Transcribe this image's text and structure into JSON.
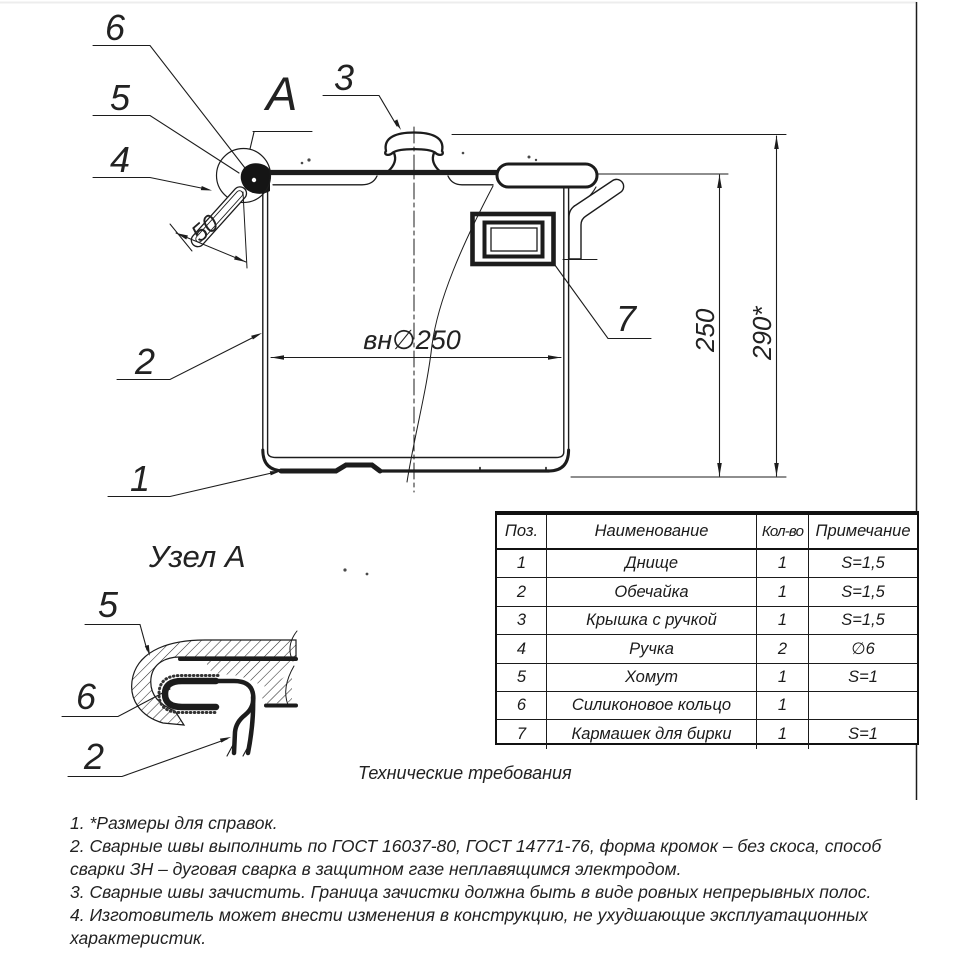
{
  "drawing": {
    "view_label": "А",
    "detail_title": "Узел А",
    "callouts": {
      "main": {
        "n1": "1",
        "n2": "2",
        "n3": "3",
        "n4": "4",
        "n5": "5",
        "n6": "6",
        "n7": "7"
      },
      "detail": {
        "n2": "2",
        "n5": "5",
        "n6": "6"
      }
    },
    "dimensions": {
      "handle_length": "50",
      "inner_diameter": "вн∅250",
      "body_height": "250",
      "total_height": "290*"
    }
  },
  "parts_table": {
    "headers": {
      "pos": "Поз.",
      "name": "Наименование",
      "qty": "Кол-во",
      "note": "Примечание"
    },
    "rows": [
      {
        "pos": "1",
        "name": "Днище",
        "qty": "1",
        "note": "S=1,5"
      },
      {
        "pos": "2",
        "name": "Обечайка",
        "qty": "1",
        "note": "S=1,5"
      },
      {
        "pos": "3",
        "name": "Крышка с ручкой",
        "qty": "1",
        "note": "S=1,5"
      },
      {
        "pos": "4",
        "name": "Ручка",
        "qty": "2",
        "note": "∅6"
      },
      {
        "pos": "5",
        "name": "Хомут",
        "qty": "1",
        "note": "S=1"
      },
      {
        "pos": "6",
        "name": "Силиконовое кольцо",
        "qty": "1",
        "note": ""
      },
      {
        "pos": "7",
        "name": "Кармашек для бирки",
        "qty": "1",
        "note": "S=1"
      }
    ]
  },
  "tech_requirements": {
    "title": "Технические требования",
    "lines": [
      "1.  *Размеры для справок.",
      "2. Сварные швы выполнить по ГОСТ 16037-80, ГОСТ 14771-76, форма кромок – без скоса, способ",
      "сварки ЗН – дуговая сварка в защитном газе неплавящимся электродом.",
      "3. Сварные швы зачистить. Граница зачистки должна быть в виде ровных непрерывных полос.",
      "4. Изготовитель может внести изменения в конструкцию, не ухудшающие эксплуатационных",
      "характеристик."
    ]
  }
}
